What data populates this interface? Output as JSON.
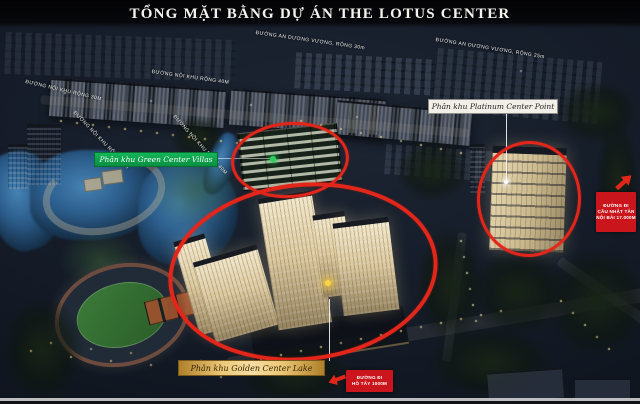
{
  "title": "TỔNG MẶT BẰNG DỰ ÁN THE LOTUS CENTER",
  "zones": [
    {
      "label": "Phân khu Green Center Villas",
      "band_color": "#0f9d4a",
      "text_color": "#ffffff"
    },
    {
      "label": "Phân khu Platinum Center Point",
      "band_color": "#f2efe8",
      "text_color": "#1d1d1d"
    },
    {
      "label": "Phân khu Golden Center Lake",
      "band_color": "#d9ab4e",
      "text_color": "#3a2704"
    }
  ],
  "streets": [
    "ĐƯỜNG NỘI KHU RỘNG 30M",
    "ĐƯỜNG AN DƯƠNG VƯƠNG, RỘNG 30m",
    "ĐƯỜNG AN DƯƠNG VƯƠNG, RỘNG 25m",
    "ĐƯỜNG NỘI KHU RỘNG 40M",
    "ĐƯỜNG NỘI KHU RỘNG 40M",
    "ĐƯỜNG NỘI KHU RỘNG 30M"
  ],
  "directions": {
    "nhat_tan": {
      "line1": "ĐƯỜNG ĐI",
      "line2": "CẦU NHẬT TÂN",
      "line3": "NỘI BÀI 17.000M"
    },
    "ho_tay": {
      "line1": "ĐƯỜNG ĐI",
      "line2": "HỒ TÂY 1000M"
    }
  },
  "colors": {
    "highlight_ellipse": "#e3261a",
    "direction_box": "#c9151b",
    "green_band": "#0f9d4a",
    "gold_band": "#d9ab4e",
    "white_band": "#f2efe8",
    "title_text": "#f4f3ee"
  }
}
